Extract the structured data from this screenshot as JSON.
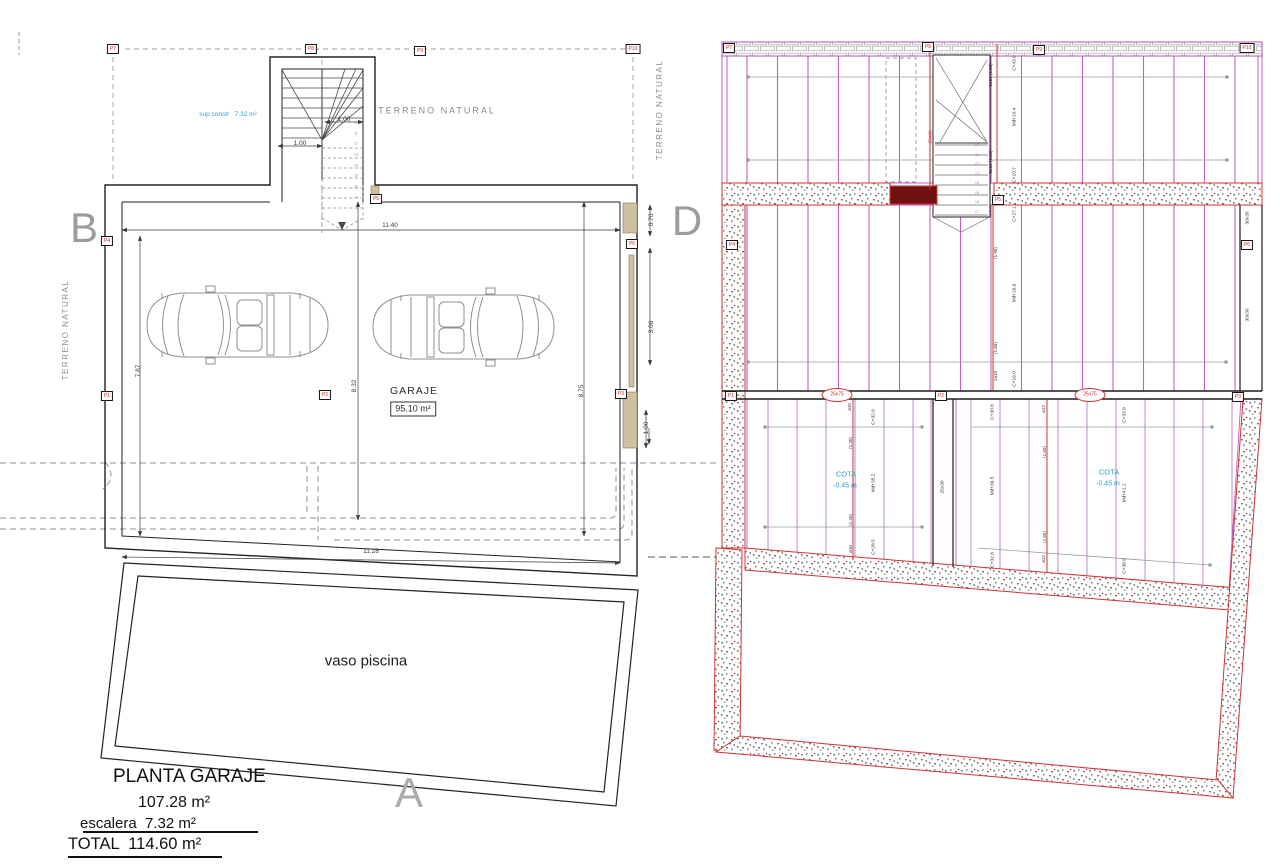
{
  "title_block": {
    "title": "PLANTA GARAJE",
    "area": "107.28 m²",
    "stairs": "escalera  7.32 m²",
    "total": "TOTAL  114.60 m²"
  },
  "colors": {
    "wall_black": "#222222",
    "accent_red": "#cf2a27",
    "magenta": "#bb4ebb",
    "joist_purple": "#c45ec4",
    "cyan_note": "#2e9fd4",
    "gray_text": "#8c8c8c",
    "tan_door": "#cbb astroke",
    "dark_red_fill": "#6f1212"
  },
  "annotations": [
    {
      "n": "terreno-natural-left",
      "t": "TERRENO NATURAL",
      "x": 66,
      "y": 330,
      "r": -90,
      "s": 8,
      "c": "#8c8c8c",
      "ls": 1.5
    },
    {
      "n": "terreno-natural-top",
      "t": "TERRENO NATURAL",
      "x": 437,
      "y": 111,
      "r": 0,
      "s": 9,
      "c": "#8c8c8c",
      "ls": 2
    },
    {
      "n": "terreno-natural-right",
      "t": "TERRENO NATURAL",
      "x": 660,
      "y": 110,
      "r": -90,
      "s": 8,
      "c": "#8c8c8c",
      "ls": 1.5
    },
    {
      "n": "sup-constr-label",
      "t": "sup constr   7.32 m²",
      "x": 228,
      "y": 115,
      "r": 0,
      "s": 6.5,
      "c": "#2e9fd4"
    },
    {
      "n": "section-letter-b",
      "t": "B",
      "x": 84,
      "y": 228,
      "r": 0,
      "s": 42,
      "c": "#9c9c9c"
    },
    {
      "n": "section-letter-d",
      "t": "D",
      "x": 687,
      "y": 221,
      "r": 0,
      "s": 42,
      "c": "#9c9c9c"
    },
    {
      "n": "section-letter-a",
      "t": "A",
      "x": 409,
      "y": 793,
      "r": 0,
      "s": 42,
      "c": "#ababab"
    },
    {
      "n": "garaje-label",
      "t": "GARAJE",
      "x": 414,
      "y": 391,
      "r": 0,
      "s": 10.5,
      "c": "#2b2b2b",
      "ls": 1
    },
    {
      "n": "garaje-area",
      "t": "95.10 m²",
      "x": 413,
      "y": 409,
      "r": 0,
      "s": 9,
      "c": "#2b2b2b",
      "box": true
    },
    {
      "n": "vaso-piscina-label",
      "t": "vaso piscina",
      "x": 366,
      "y": 661,
      "r": 0,
      "s": 15,
      "c": "#1e1e1e"
    },
    {
      "n": "dim-11-40",
      "t": "11.40",
      "x": 390,
      "y": 226,
      "r": 0,
      "s": 6.5,
      "c": "#3a3a3a"
    },
    {
      "n": "dim-7-87",
      "t": "7.87",
      "x": 139,
      "y": 371,
      "r": -90,
      "s": 6.5,
      "c": "#3a3a3a"
    },
    {
      "n": "dim-8-32",
      "t": "8.32",
      "x": 355,
      "y": 386,
      "r": -90,
      "s": 6.5,
      "c": "#3a3a3a"
    },
    {
      "n": "dim-8-75",
      "t": "8.75",
      "x": 582,
      "y": 391,
      "r": -90,
      "s": 6.5,
      "c": "#3a3a3a"
    },
    {
      "n": "dim-11-28",
      "t": "11.28",
      "x": 371,
      "y": 552,
      "r": 0,
      "s": 6.5,
      "c": "#3a3a3a"
    },
    {
      "n": "dim-0-70",
      "t": "0.70",
      "x": 652,
      "y": 220,
      "r": -90,
      "s": 6.5,
      "c": "#3a3a3a"
    },
    {
      "n": "dim-3-06",
      "t": "3.06",
      "x": 652,
      "y": 327,
      "r": -90,
      "s": 6.5,
      "c": "#3a3a3a"
    },
    {
      "n": "dim-1-00-right",
      "t": "1.00",
      "x": 647,
      "y": 428,
      "r": -90,
      "s": 6.5,
      "c": "#3a3a3a"
    },
    {
      "n": "dim-1-00-stair-a",
      "t": "1.00",
      "x": 344,
      "y": 120,
      "r": 0,
      "s": 6.5,
      "c": "#3a3a3a"
    },
    {
      "n": "dim-1-00-stair-b",
      "t": "1.00",
      "x": 300,
      "y": 144,
      "r": 0,
      "s": 6.5,
      "c": "#3a3a3a"
    },
    {
      "n": "stair-step-number",
      "t": "10",
      "x": 356,
      "y": 123,
      "r": 0,
      "s": 3.5,
      "c": "#8a8a8a"
    },
    {
      "n": "stair-step-number",
      "t": "11",
      "x": 356,
      "y": 134,
      "r": 0,
      "s": 3.5,
      "c": "#8a8a8a"
    },
    {
      "n": "stair-step-number",
      "t": "12",
      "x": 356,
      "y": 144,
      "r": 0,
      "s": 3.5,
      "c": "#8a8a8a"
    },
    {
      "n": "stair-step-number",
      "t": "13",
      "x": 356,
      "y": 155,
      "r": 0,
      "s": 3.5,
      "c": "#8a8a8a"
    },
    {
      "n": "stair-step-number",
      "t": "14",
      "x": 356,
      "y": 166,
      "r": 0,
      "s": 3.5,
      "c": "#8a8a8a"
    },
    {
      "n": "stair-step-number",
      "t": "15",
      "x": 356,
      "y": 176,
      "r": 0,
      "s": 3.5,
      "c": "#8a8a8a"
    },
    {
      "n": "stair-step-number",
      "t": "16",
      "x": 356,
      "y": 187,
      "r": 0,
      "s": 3.5,
      "c": "#8a8a8a"
    },
    {
      "n": "stair-step-number",
      "t": "17",
      "x": 356,
      "y": 198,
      "r": 0,
      "s": 3.5,
      "c": "#8a8a8a"
    },
    {
      "n": "beam-label",
      "t": "C+43.9",
      "x": 1016,
      "y": 63,
      "r": -90,
      "s": 4.8,
      "c": "#333333"
    },
    {
      "n": "beam-label",
      "t": "Md+10.4",
      "x": 1016,
      "y": 117,
      "r": -90,
      "s": 4.8,
      "c": "#333333"
    },
    {
      "n": "beam-label",
      "t": "C+10.7",
      "x": 1016,
      "y": 175,
      "r": -90,
      "s": 4.8,
      "c": "#333333"
    },
    {
      "n": "beam-label",
      "t": "C+27.1",
      "x": 1016,
      "y": 214,
      "r": -90,
      "s": 4.8,
      "c": "#333333"
    },
    {
      "n": "beam-label",
      "t": "Md+16.9",
      "x": 1016,
      "y": 293,
      "r": -90,
      "s": 4.8,
      "c": "#333333"
    },
    {
      "n": "beam-label",
      "t": "C+19.0",
      "x": 1016,
      "y": 379,
      "r": -90,
      "s": 4.8,
      "c": "#333333"
    },
    {
      "n": "rebar-label",
      "t": "1ø10 (1.10)",
      "x": 991,
      "y": 75,
      "r": -90,
      "s": 4.5,
      "c": "#333333"
    },
    {
      "n": "rebar-label",
      "t": "3ø10 (1.10)",
      "x": 991,
      "y": 162,
      "r": -90,
      "s": 4.5,
      "c": "#333333"
    },
    {
      "n": "rebar-label",
      "t": "(1.90)",
      "x": 996,
      "y": 253,
      "r": -90,
      "s": 4.5,
      "c": "#333333"
    },
    {
      "n": "rebar-label",
      "t": "(1.66)",
      "x": 996,
      "y": 348,
      "r": -90,
      "s": 4.5,
      "c": "#333333"
    },
    {
      "n": "rebar-label",
      "t": "1ø10",
      "x": 996,
      "y": 376,
      "r": -90,
      "s": 4.5,
      "c": "#333333"
    },
    {
      "n": "beam-size-label",
      "t": "25x30",
      "x": 932,
      "y": 137,
      "r": -90,
      "s": 4.8,
      "c": "#cf2a27"
    },
    {
      "n": "beam-size-label",
      "t": "25x30",
      "x": 944,
      "y": 487,
      "r": -90,
      "s": 4.8,
      "c": "#333333"
    },
    {
      "n": "beam-size-label",
      "t": "30x30",
      "x": 1249,
      "y": 218,
      "r": -90,
      "s": 4.8,
      "c": "#333333"
    },
    {
      "n": "beam-size-label",
      "t": "30x30",
      "x": 1249,
      "y": 315,
      "r": -90,
      "s": 4.8,
      "c": "#333333"
    },
    {
      "n": "beam-size-label",
      "t": "25x75",
      "x": 837,
      "y": 395,
      "r": 0,
      "s": 5,
      "c": "#cf2a27"
    },
    {
      "n": "beam-size-label",
      "t": "25x75",
      "x": 1090,
      "y": 395,
      "r": 0,
      "s": 5,
      "c": "#cf2a27"
    },
    {
      "n": "rebar-label",
      "t": "ø10",
      "x": 850,
      "y": 407,
      "r": -90,
      "s": 4.5,
      "c": "#333333"
    },
    {
      "n": "rebar-label",
      "t": "(1.30)",
      "x": 851,
      "y": 443,
      "r": -90,
      "s": 4.5,
      "c": "#333333"
    },
    {
      "n": "rebar-label",
      "t": "(1.40)",
      "x": 851,
      "y": 520,
      "r": -90,
      "s": 4.5,
      "c": "#333333"
    },
    {
      "n": "rebar-label",
      "t": "ø10",
      "x": 851,
      "y": 549,
      "r": -90,
      "s": 4.5,
      "c": "#333333"
    },
    {
      "n": "beam-label",
      "t": "C+32.9",
      "x": 875,
      "y": 417,
      "r": -90,
      "s": 4.8,
      "c": "#333333"
    },
    {
      "n": "beam-label",
      "t": "Md+35.2",
      "x": 875,
      "y": 483,
      "r": -90,
      "s": 4.8,
      "c": "#333333"
    },
    {
      "n": "beam-label",
      "t": "C+28.5",
      "x": 875,
      "y": 547,
      "r": -90,
      "s": 4.8,
      "c": "#333333"
    },
    {
      "n": "beam-label",
      "t": "C+30.8",
      "x": 994,
      "y": 412,
      "r": -90,
      "s": 4.8,
      "c": "#333333"
    },
    {
      "n": "beam-label",
      "t": "Md+39.5",
      "x": 994,
      "y": 486,
      "r": -90,
      "s": 4.8,
      "c": "#333333"
    },
    {
      "n": "beam-label",
      "t": "C+32.8",
      "x": 994,
      "y": 560,
      "r": -90,
      "s": 4.8,
      "c": "#333333"
    },
    {
      "n": "rebar-label",
      "t": "ø12",
      "x": 1044,
      "y": 409,
      "r": -90,
      "s": 4.5,
      "c": "#333333"
    },
    {
      "n": "rebar-label",
      "t": "(1.60)",
      "x": 1045,
      "y": 452,
      "r": -90,
      "s": 4.5,
      "c": "#333333"
    },
    {
      "n": "rebar-label",
      "t": "(1.65)",
      "x": 1045,
      "y": 537,
      "r": -90,
      "s": 4.5,
      "c": "#333333"
    },
    {
      "n": "rebar-label",
      "t": "ø12",
      "x": 1044,
      "y": 559,
      "r": -90,
      "s": 4.5,
      "c": "#333333"
    },
    {
      "n": "beam-label",
      "t": "C+33.9",
      "x": 1126,
      "y": 415,
      "r": -90,
      "s": 4.8,
      "c": "#333333"
    },
    {
      "n": "beam-label",
      "t": "Md+41.1",
      "x": 1126,
      "y": 493,
      "r": -90,
      "s": 4.8,
      "c": "#333333"
    },
    {
      "n": "beam-label",
      "t": "C+38.5",
      "x": 1126,
      "y": 566,
      "r": -90,
      "s": 4.8,
      "c": "#333333"
    },
    {
      "n": "cota-label",
      "t": "COTA",
      "x": 846,
      "y": 474,
      "r": 0,
      "s": 7.5,
      "c": "#2e9fd4"
    },
    {
      "n": "cota-value",
      "t": "-0.45 m",
      "x": 845,
      "y": 486,
      "r": 0,
      "s": 7,
      "c": "#2e9fd4"
    },
    {
      "n": "cota-label",
      "t": "COTA",
      "x": 1109,
      "y": 472,
      "r": 0,
      "s": 7.5,
      "c": "#2e9fd4"
    },
    {
      "n": "cota-value",
      "t": "-0.45 m",
      "x": 1108,
      "y": 484,
      "r": 0,
      "s": 7,
      "c": "#2e9fd4"
    },
    {
      "n": "stair-step-number",
      "t": "10",
      "x": 977,
      "y": 146,
      "r": 0,
      "s": 3.8,
      "c": "#8a8a8a"
    },
    {
      "n": "stair-step-number",
      "t": "11",
      "x": 977,
      "y": 156,
      "r": 0,
      "s": 3.8,
      "c": "#8a8a8a"
    },
    {
      "n": "stair-step-number",
      "t": "12",
      "x": 977,
      "y": 165,
      "r": 0,
      "s": 3.8,
      "c": "#8a8a8a"
    },
    {
      "n": "stair-step-number",
      "t": "13",
      "x": 977,
      "y": 175,
      "r": 0,
      "s": 3.8,
      "c": "#8a8a8a"
    },
    {
      "n": "stair-step-number",
      "t": "14",
      "x": 977,
      "y": 184,
      "r": 0,
      "s": 3.8,
      "c": "#8a8a8a"
    },
    {
      "n": "stair-step-number",
      "t": "15",
      "x": 977,
      "y": 194,
      "r": 0,
      "s": 3.8,
      "c": "#8a8a8a"
    },
    {
      "n": "stair-step-number",
      "t": "16",
      "x": 977,
      "y": 203,
      "r": 0,
      "s": 3.8,
      "c": "#8a8a8a"
    },
    {
      "n": "stair-step-number",
      "t": "17",
      "x": 977,
      "y": 213,
      "r": 0,
      "s": 3.8,
      "c": "#8a8a8a"
    }
  ],
  "pillars": [
    {
      "n": "pillar-marker-p7-left",
      "t": "P7",
      "x": 113,
      "y": 49
    },
    {
      "n": "pillar-marker-p8-left",
      "t": "P8",
      "x": 311,
      "y": 49
    },
    {
      "n": "pillar-marker-p9-left",
      "t": "P9",
      "x": 420,
      "y": 51
    },
    {
      "n": "pillar-marker-p10-left",
      "t": "P10",
      "x": 633,
      "y": 49
    },
    {
      "n": "pillar-marker-p4-left",
      "t": "P4",
      "x": 107,
      "y": 241
    },
    {
      "n": "pillar-marker-p5-left",
      "t": "P5",
      "x": 376,
      "y": 199
    },
    {
      "n": "pillar-marker-p6-left",
      "t": "P6",
      "x": 632,
      "y": 244
    },
    {
      "n": "pillar-marker-p1-left",
      "t": "P1",
      "x": 107,
      "y": 396
    },
    {
      "n": "pillar-marker-p2-left",
      "t": "P2",
      "x": 325,
      "y": 395
    },
    {
      "n": "pillar-marker-p3-left",
      "t": "P3",
      "x": 621,
      "y": 394
    },
    {
      "n": "pillar-marker-p7-right",
      "t": "P7",
      "x": 729,
      "y": 48
    },
    {
      "n": "pillar-marker-p8-right",
      "t": "P8",
      "x": 928,
      "y": 47
    },
    {
      "n": "pillar-marker-p9-right",
      "t": "P9",
      "x": 1039,
      "y": 50
    },
    {
      "n": "pillar-marker-p10-right",
      "t": "P10",
      "x": 1247,
      "y": 48
    },
    {
      "n": "pillar-marker-p4-right",
      "t": "P4",
      "x": 732,
      "y": 245
    },
    {
      "n": "pillar-marker-p5-right",
      "t": "P5",
      "x": 998,
      "y": 200
    },
    {
      "n": "pillar-marker-p6-right",
      "t": "P6",
      "x": 1247,
      "y": 245
    },
    {
      "n": "pillar-marker-p1-right",
      "t": "P1",
      "x": 731,
      "y": 396
    },
    {
      "n": "pillar-marker-p2-right",
      "t": "P2",
      "x": 941,
      "y": 396
    },
    {
      "n": "pillar-marker-p3-right",
      "t": "P3",
      "x": 1238,
      "y": 397
    }
  ]
}
